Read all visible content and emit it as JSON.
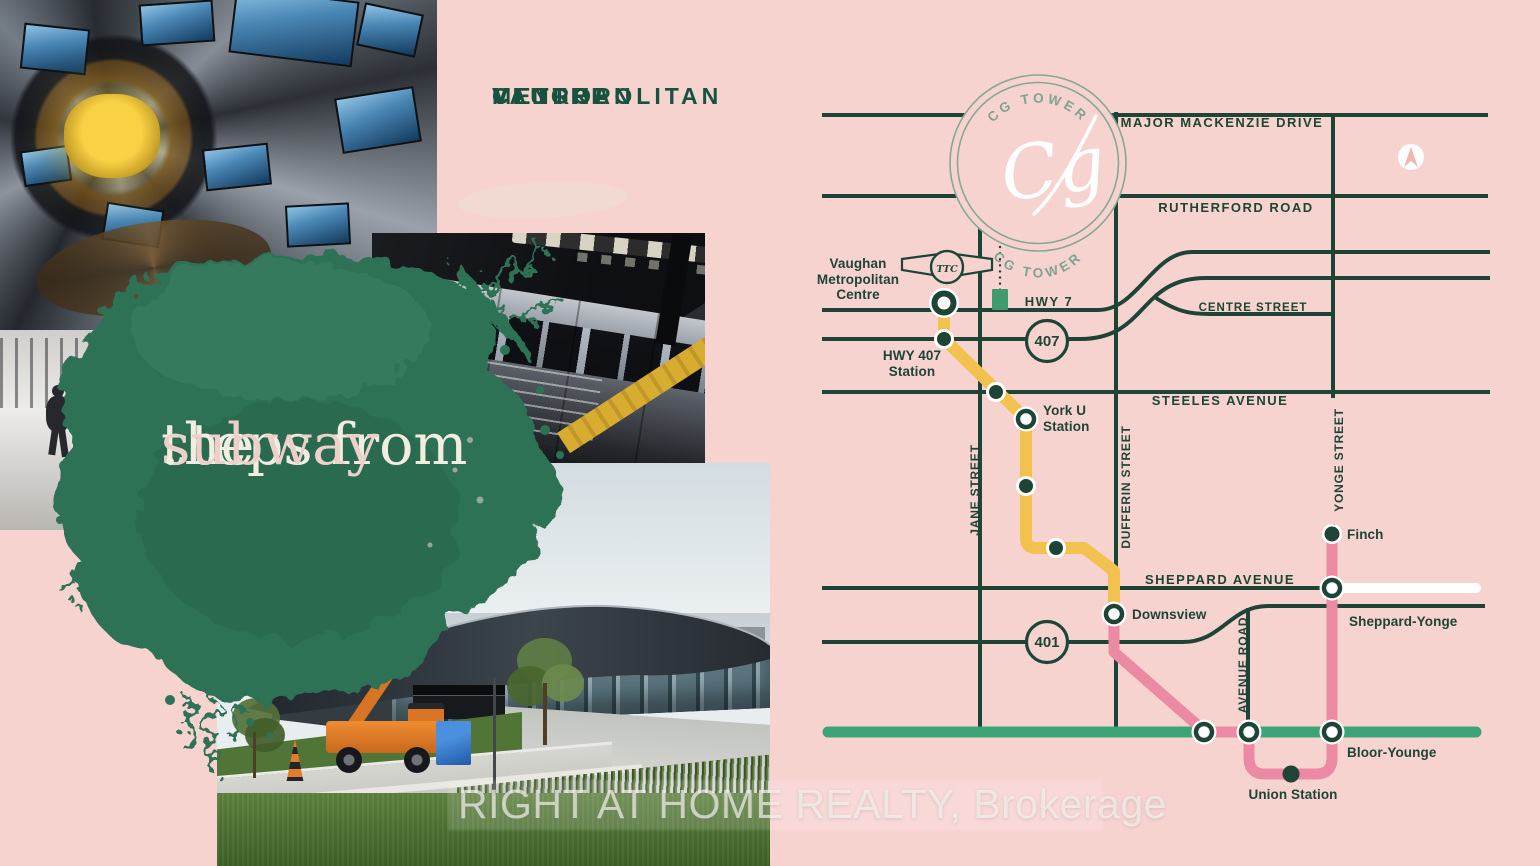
{
  "poster": {
    "heading": {
      "lines": [
        "VAUGHAN",
        "METROPOLITAN",
        "CENTRE"
      ]
    },
    "tagline": {
      "line1": "steps from",
      "line2_pre": "the ",
      "line2_accent": "subway",
      "line2_end": "."
    },
    "watermark": "RIGHT AT HOME REALTY, Brokerage"
  },
  "badge": {
    "arc_top": "CG TOWER",
    "arc_bottom": "CG TOWER",
    "monogram": "Cg"
  },
  "ttc": {
    "monogram": "TTC"
  },
  "map": {
    "road_labels": {
      "major_mackenzie": "MAJOR MACKENZIE DRIVE",
      "rutherford": "RUTHERFORD ROAD",
      "hwy7": "HWY 7",
      "centre": "CENTRE STREET",
      "steeles": "STEELES AVENUE",
      "sheppard": "SHEPPARD AVENUE",
      "jane": "JANE STREET",
      "dufferin": "DUFFERIN STREET",
      "yonge": "YONGE STREET",
      "avenue_road": "AVENUE ROAD"
    },
    "highway_shields": {
      "hwy407": "407",
      "hwy401": "401"
    },
    "stations": {
      "vmc": {
        "lines": [
          "Vaughan",
          "Metropolitan",
          "Centre"
        ]
      },
      "hwy407_station": {
        "lines": [
          "HWY 407",
          "Station"
        ]
      },
      "york_u": {
        "lines": [
          "York U",
          "Station"
        ]
      },
      "downsview": "Downsview",
      "finch": "Finch",
      "sheppard_yonge": "Sheppard-Yonge",
      "bloor_younge": "Bloor-Younge",
      "union": "Union Station"
    },
    "legend_colors": {
      "line1_extension_yellow": "#f2c14e",
      "line1_yonge_university_pink": "#ec8aa3",
      "line2_bloor_danforth_green": "#3da478",
      "line4_sheppard_white": "#ffffff",
      "roads_dark_green": "#1d4434",
      "background_pink": "#f7d3d0",
      "splash_green": "#2e7256",
      "badge_sage": "#7ea391"
    }
  }
}
